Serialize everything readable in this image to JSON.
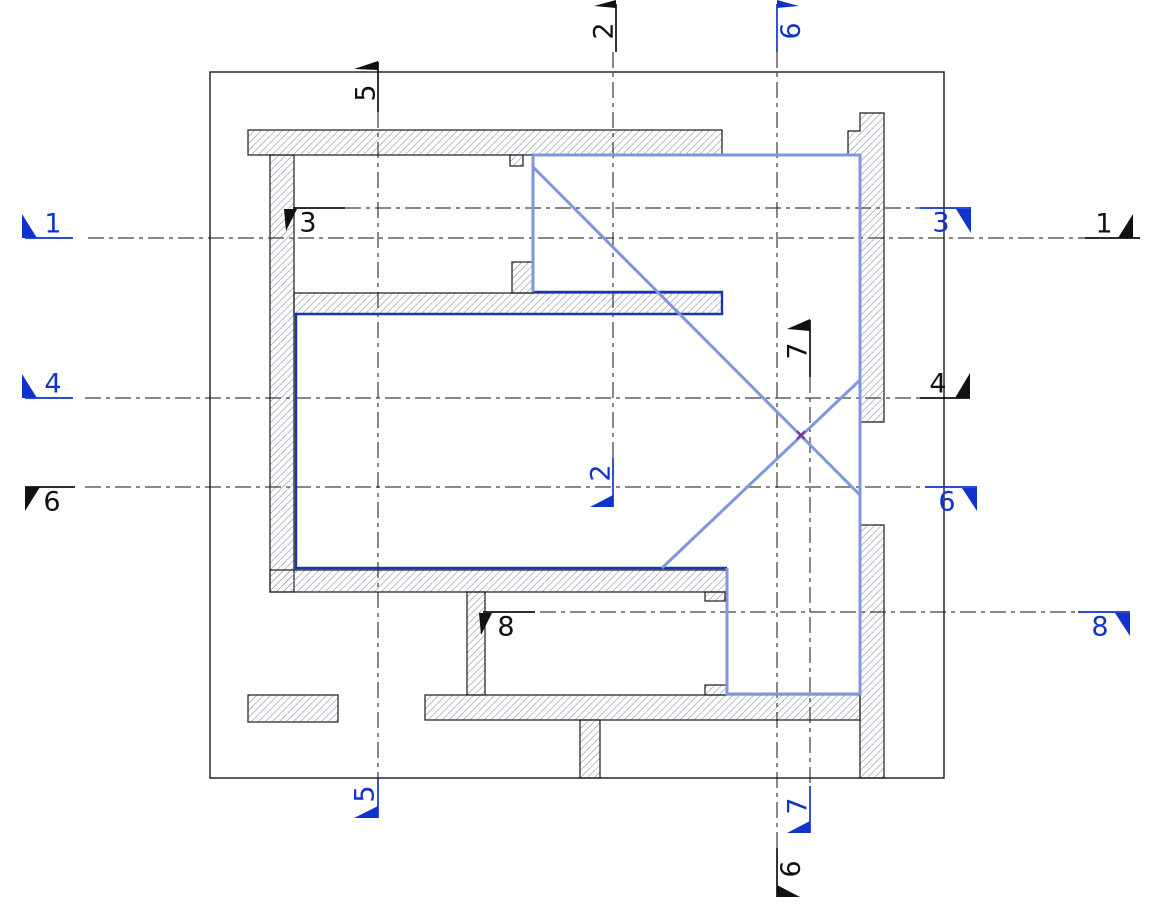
{
  "drawing": {
    "description": "Architectural floor plan with section cut markers",
    "colors": {
      "marker_blue": "#1133cc",
      "marker_black": "#111111",
      "wall_outline": "#1a1a1a",
      "room_outline_navy": "#1b35ad",
      "highlight_blue": "#7e97dd",
      "hatch_gray": "#9aa2b1",
      "intersection_cross_purple": "#7d2e8d"
    },
    "markers": [
      {
        "id": "top-2",
        "label": "2",
        "color": "black"
      },
      {
        "id": "top-9",
        "label": "9",
        "color": "blue"
      },
      {
        "id": "top-5",
        "label": "5",
        "color": "black"
      },
      {
        "id": "left-1",
        "label": "1",
        "color": "blue"
      },
      {
        "id": "left-4",
        "label": "4",
        "color": "blue"
      },
      {
        "id": "left-6",
        "label": "6",
        "color": "black"
      },
      {
        "id": "inner-3",
        "label": "3",
        "color": "black"
      },
      {
        "id": "right-3",
        "label": "3",
        "color": "blue"
      },
      {
        "id": "right-1",
        "label": "1",
        "color": "black"
      },
      {
        "id": "right-4",
        "label": "4",
        "color": "black"
      },
      {
        "id": "right-6",
        "label": "6",
        "color": "blue"
      },
      {
        "id": "inner-2",
        "label": "2",
        "color": "blue"
      },
      {
        "id": "inner-7",
        "label": "7",
        "color": "black"
      },
      {
        "id": "inner-8",
        "label": "8",
        "color": "black"
      },
      {
        "id": "right-8",
        "label": "8",
        "color": "blue"
      },
      {
        "id": "bottom-5",
        "label": "5",
        "color": "blue"
      },
      {
        "id": "bottom-7",
        "label": "7",
        "color": "blue"
      },
      {
        "id": "bottom-9",
        "label": "9",
        "color": "black"
      }
    ]
  }
}
